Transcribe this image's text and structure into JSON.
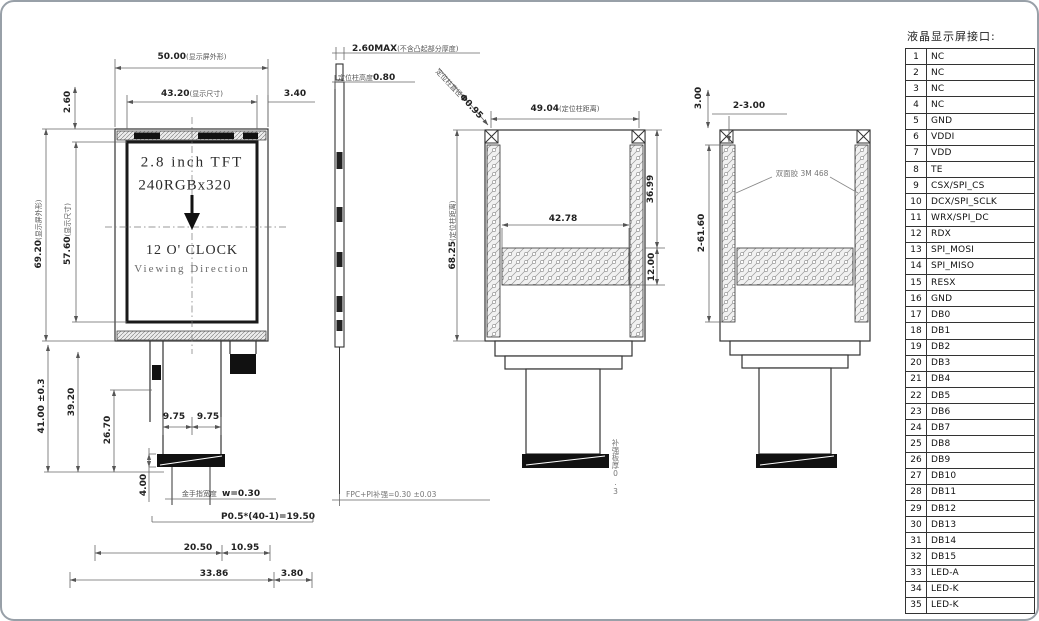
{
  "pin_table": {
    "title": "液晶显示屏接口:",
    "pins": [
      {
        "no": "1",
        "name": "NC"
      },
      {
        "no": "2",
        "name": "NC"
      },
      {
        "no": "3",
        "name": "NC"
      },
      {
        "no": "4",
        "name": "NC"
      },
      {
        "no": "5",
        "name": "GND"
      },
      {
        "no": "6",
        "name": "VDDI"
      },
      {
        "no": "7",
        "name": "VDD"
      },
      {
        "no": "8",
        "name": "TE"
      },
      {
        "no": "9",
        "name": "CSX/SPI_CS"
      },
      {
        "no": "10",
        "name": "DCX/SPI_SCLK"
      },
      {
        "no": "11",
        "name": "WRX/SPI_DC"
      },
      {
        "no": "12",
        "name": "RDX"
      },
      {
        "no": "13",
        "name": "SPI_MOSI"
      },
      {
        "no": "14",
        "name": "SPI_MISO"
      },
      {
        "no": "15",
        "name": "RESX"
      },
      {
        "no": "16",
        "name": "GND"
      },
      {
        "no": "17",
        "name": "DB0"
      },
      {
        "no": "18",
        "name": "DB1"
      },
      {
        "no": "19",
        "name": "DB2"
      },
      {
        "no": "20",
        "name": "DB3"
      },
      {
        "no": "21",
        "name": "DB4"
      },
      {
        "no": "22",
        "name": "DB5"
      },
      {
        "no": "23",
        "name": "DB6"
      },
      {
        "no": "24",
        "name": "DB7"
      },
      {
        "no": "25",
        "name": "DB8"
      },
      {
        "no": "26",
        "name": "DB9"
      },
      {
        "no": "27",
        "name": "DB10"
      },
      {
        "no": "28",
        "name": "DB11"
      },
      {
        "no": "29",
        "name": "DB12"
      },
      {
        "no": "30",
        "name": "DB13"
      },
      {
        "no": "31",
        "name": "DB14"
      },
      {
        "no": "32",
        "name": "DB15"
      },
      {
        "no": "33",
        "name": "LED-A"
      },
      {
        "no": "34",
        "name": "LED-K"
      },
      {
        "no": "35",
        "name": "LED-K"
      }
    ]
  },
  "front_view": {
    "screen": {
      "line1": "2.8 inch TFT",
      "line2": "240RGBx320",
      "line3": "12 O' CLOCK",
      "line4": "Viewing Direction"
    },
    "dims": {
      "outer_w": {
        "v": "50.00",
        "q": "(显示屏外形)"
      },
      "view_w": {
        "v": "43.20",
        "q": "(显示尺寸)"
      },
      "right_gap": {
        "v": "3.40"
      },
      "top_gap": {
        "v": "2.60"
      },
      "outer_h": {
        "v": "69.20",
        "q": "(显示屏外形)"
      },
      "view_h": {
        "v": "57.60",
        "q": "(显示尺寸)"
      },
      "tail_h": {
        "v": "41.00 ±0.3"
      },
      "tail_h2": {
        "v": "39.20"
      },
      "tail_h3": {
        "v": "26.70"
      },
      "finger_l": {
        "v": "9.75"
      },
      "finger_r": {
        "v": "9.75"
      },
      "stiff_h": {
        "v": "4.00"
      },
      "gold_note": {
        "q": "金手指宽度",
        "v": "w=0.30"
      },
      "pitch_note": {
        "v": "P0.5*(40-1)=19.50"
      },
      "w1": {
        "v": "20.50"
      },
      "w2": {
        "v": "10.95"
      },
      "w3": {
        "v": "33.86"
      },
      "w4": {
        "v": "3.80"
      }
    }
  },
  "side_view": {
    "thickness": {
      "v": "2.60MAX",
      "q": "(不含凸起部分厚度)"
    },
    "post_h": {
      "q": "定位柱高度",
      "v": "0.80"
    },
    "post_d": {
      "q": "定位柱直径",
      "v": "Φ0.95"
    },
    "fpc_note": {
      "v": "FPC+PI补强=0.30 ±0.03"
    }
  },
  "back_view_1": {
    "post_dist_w": {
      "v": "49.04",
      "q": "(定位柱距离)"
    },
    "post_dist_h": {
      "v": "68.25",
      "q": "(定位柱距离)"
    },
    "dim_a": {
      "v": "36.99"
    },
    "dim_b": {
      "v": "42.78"
    },
    "dim_c": {
      "v": "12.00"
    },
    "tail_note": {
      "v": "补强板厚0.3"
    }
  },
  "back_view_2": {
    "tape_len": {
      "v": "2-61.60"
    },
    "tape_top": {
      "v": "3.00"
    },
    "tape_w": {
      "v": "2-3.00"
    },
    "tape_note": {
      "v": "双面胶 3M 468"
    }
  }
}
